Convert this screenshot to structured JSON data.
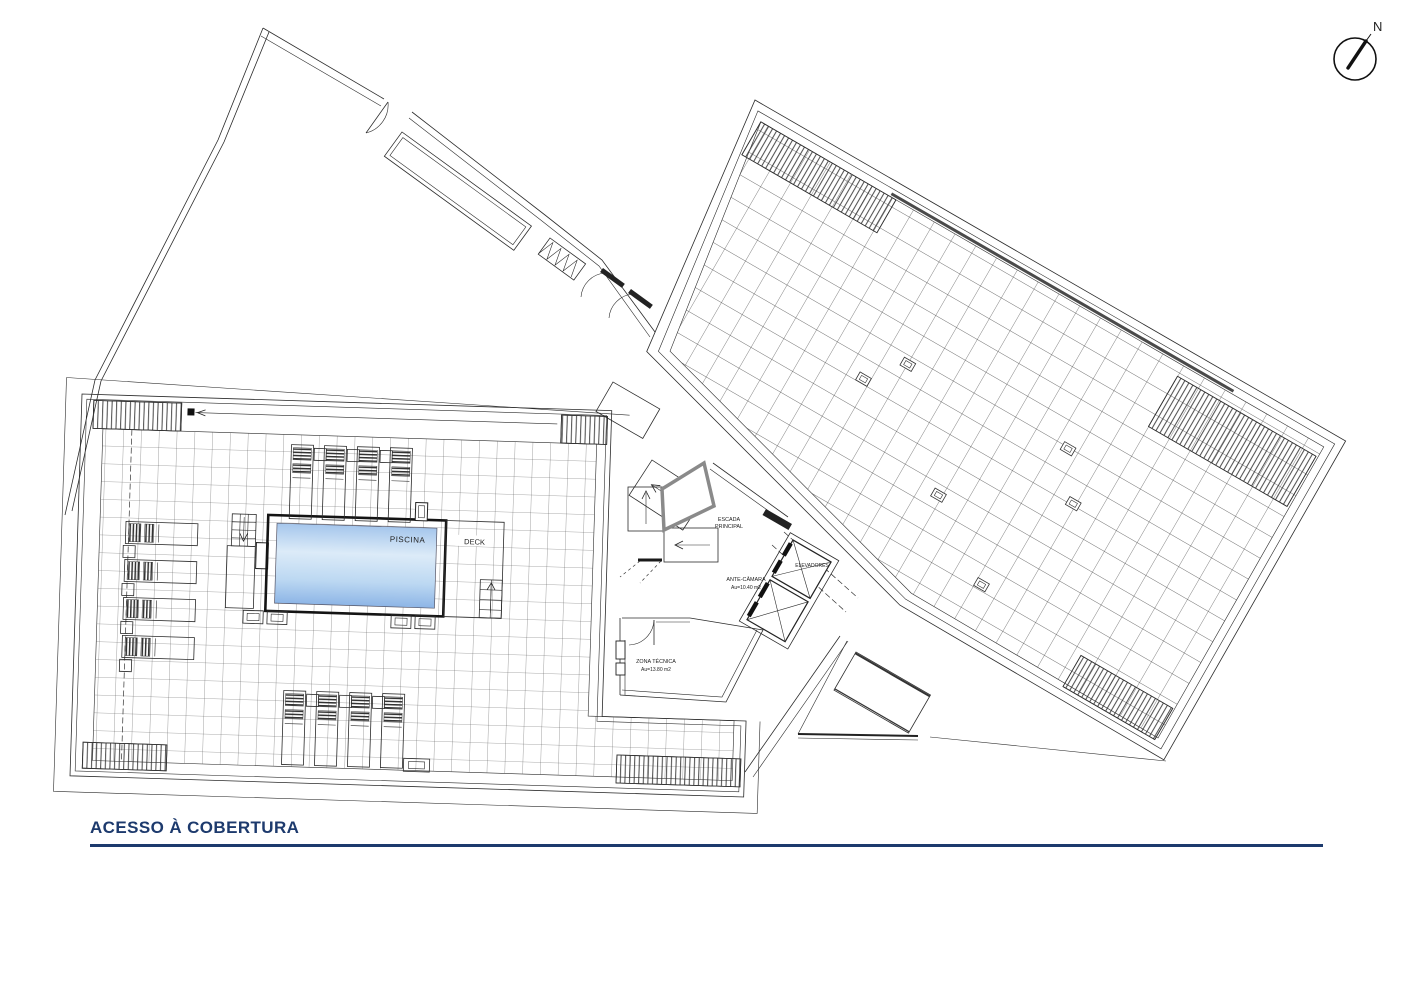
{
  "title": {
    "label": "ACESSO À COBERTURA"
  },
  "compass": {
    "label": "N"
  },
  "plan_labels": {
    "pool": "PISCINA",
    "deck": "DECK",
    "main_stair_line1": "ESCADA",
    "main_stair_line2": "PRINCIPAL",
    "ante_chamber": "ANTE-CÂMARA",
    "ante_chamber_area": "Au=10.40 m2",
    "elevators": "ELEVADORES",
    "technical_zone": "ZONA TÉCNICA",
    "technical_zone_area": "Au=13.80 m2"
  },
  "colors": {
    "title_navy": "#1d3a6d",
    "line_dark": "#2b2b2b",
    "pool_top": "#a5c6ec",
    "pool_mid": "#dcebf8",
    "pool_lower_mid": "#bcd8f2",
    "pool_bottom": "#8db5e6",
    "pool_label_text": "#3c4a63"
  }
}
